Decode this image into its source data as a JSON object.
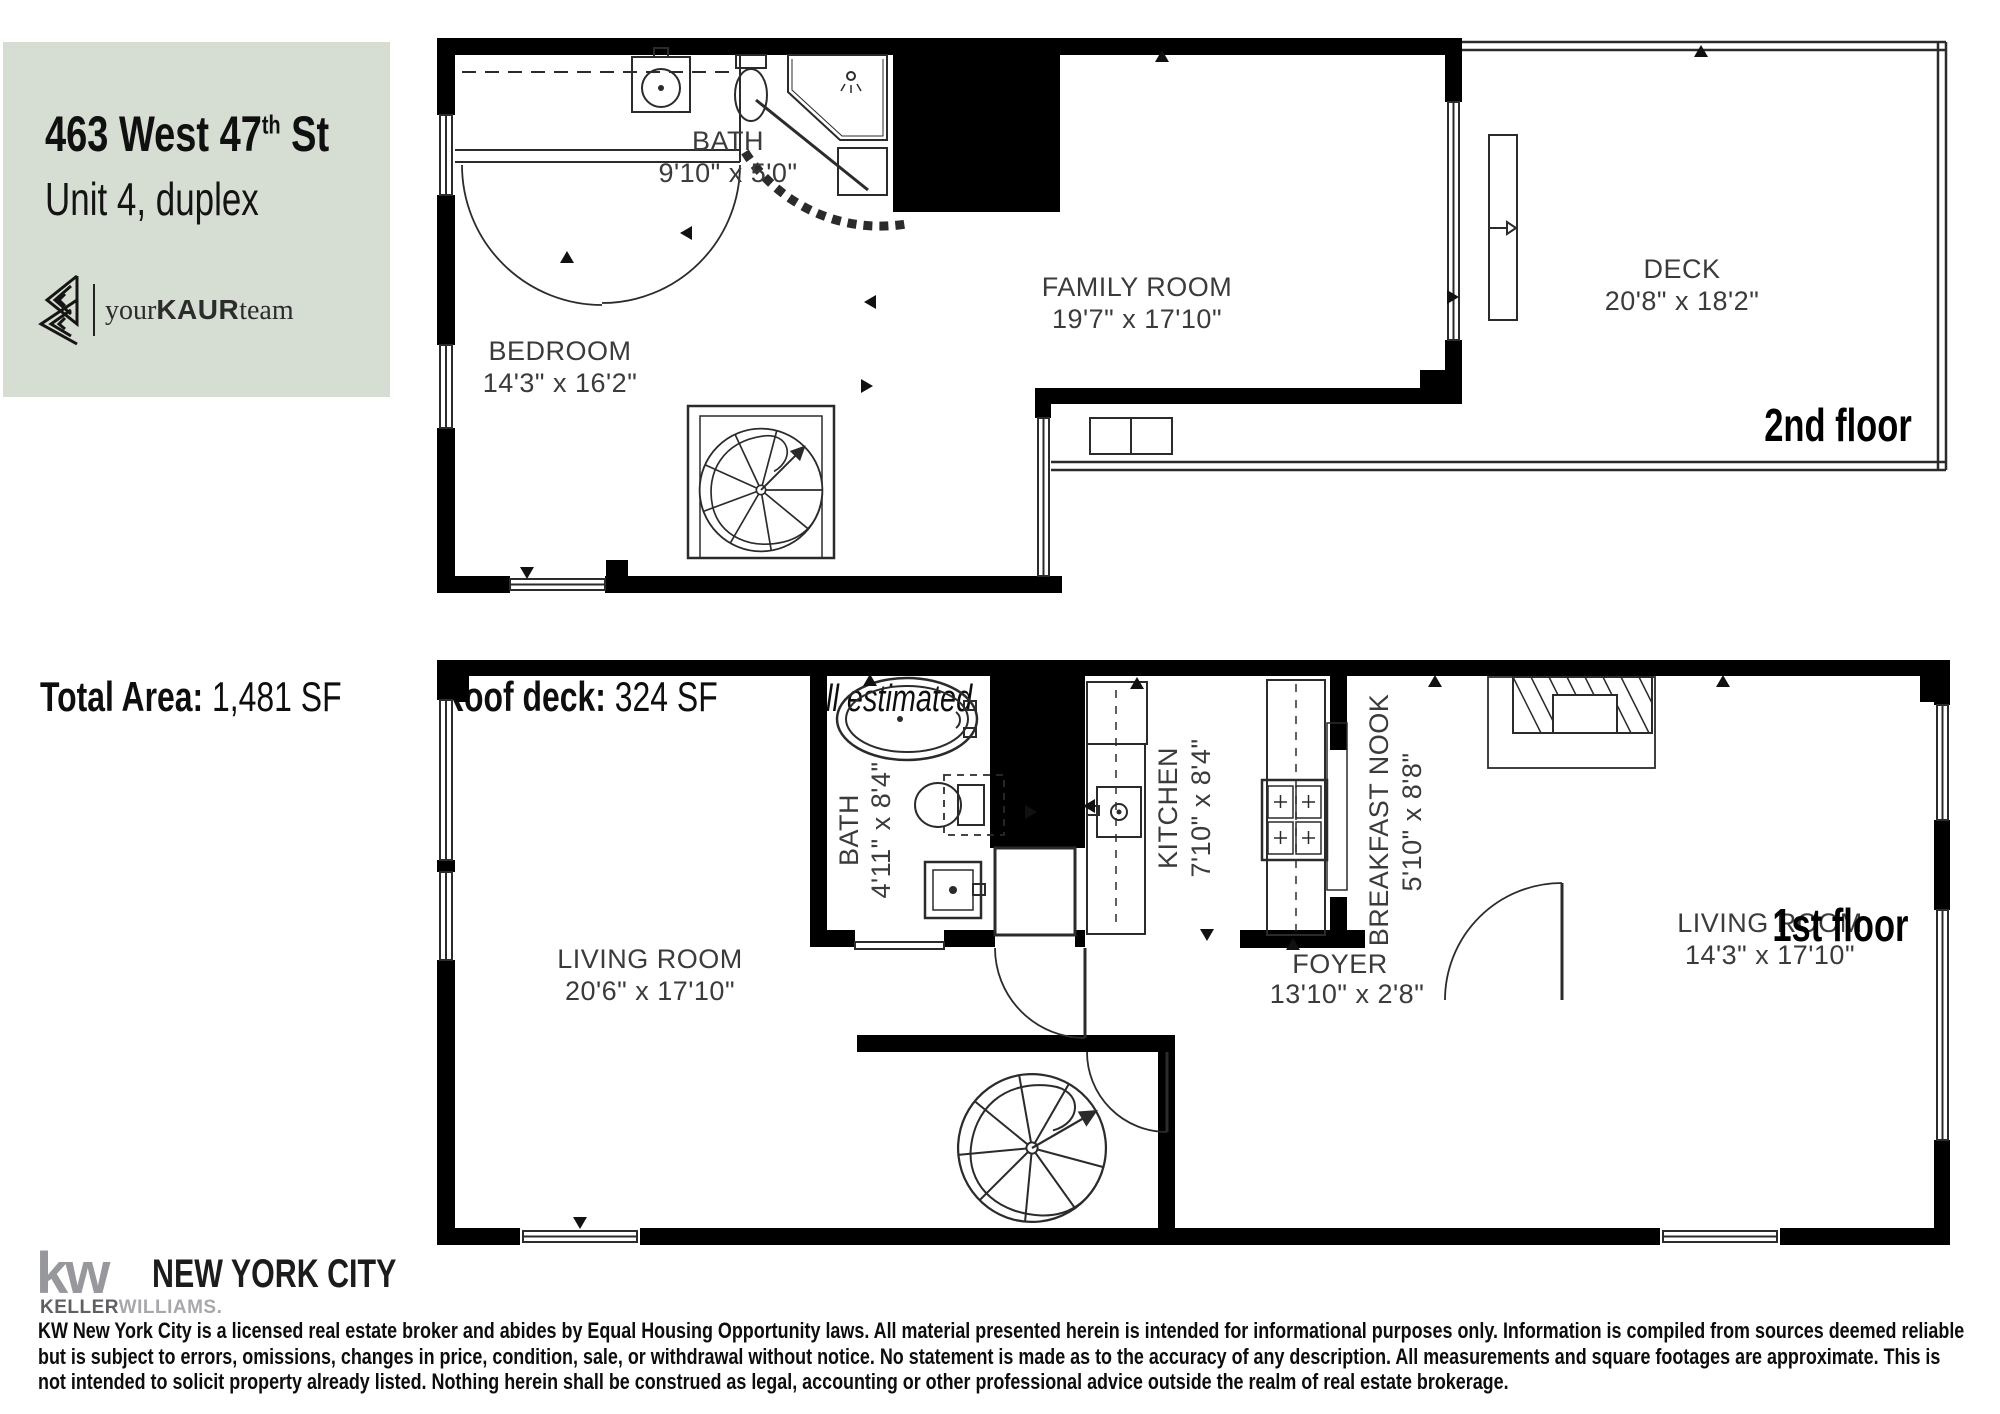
{
  "colors": {
    "header_bg": "#d6ddd2",
    "wall": "#000000",
    "thin_line": "#2b2b2b",
    "room_label": "#3b3b3b",
    "kw_gray": "#97989b"
  },
  "header": {
    "address_main": "463 West 47",
    "address_sup": "th",
    "address_tail": " St",
    "unit": "Unit 4, duplex",
    "logo_your": "your",
    "logo_kaur": "KAUR",
    "logo_team": "team"
  },
  "stats": {
    "total_label": "Total Area:",
    "total_value": " 1,481 SF",
    "roof_label": "Roof deck:",
    "roof_value": " 324 SF",
    "note": "all estimated"
  },
  "floor2": {
    "floor_label": "2nd floor",
    "bath": {
      "name": "BATH",
      "dims": "9'10\" x 5'0\""
    },
    "bedroom": {
      "name": "BEDROOM",
      "dims": "14'3\" x 16'2\""
    },
    "family": {
      "name": "FAMILY ROOM",
      "dims": "19'7\" x 17'10\""
    },
    "deck": {
      "name": "DECK",
      "dims": "20'8\" x 18'2\""
    }
  },
  "floor1": {
    "floor_label": "1st floor",
    "living_left": {
      "name": "LIVING ROOM",
      "dims": "20'6\" x 17'10\""
    },
    "bath": {
      "name": "BATH",
      "dims": "4'11\" x 8'4\""
    },
    "kitchen": {
      "name": "KITCHEN",
      "dims": "7'10\" x 8'4\""
    },
    "nook": {
      "name": "BREAKFAST NOOK",
      "dims": "5'10\" x 8'8\""
    },
    "foyer": {
      "name": "FOYER",
      "dims": "13'10\" x 2'8\""
    },
    "living_right": {
      "name": "LIVING ROOM",
      "dims": "14'3\" x 17'10\""
    }
  },
  "footer": {
    "kw": "kw",
    "brand": "NEW YORK CITY",
    "keller": "KELLER",
    "williams": "WILLIAMS.",
    "disclaimer": "KW New York City is a licensed real estate broker and abides by Equal Housing Opportunity laws. All material presented herein is intended for informational purposes only. Information is compiled from sources deemed reliable but is subject to errors, omissions, changes in price, condition, sale, or withdrawal without notice. No statement is made as to the accuracy of any description. All measurements and square footages are approximate. This is not intended to solicit property already listed. Nothing herein shall be construed as legal, accounting or other professional advice outside the realm of real estate brokerage."
  }
}
